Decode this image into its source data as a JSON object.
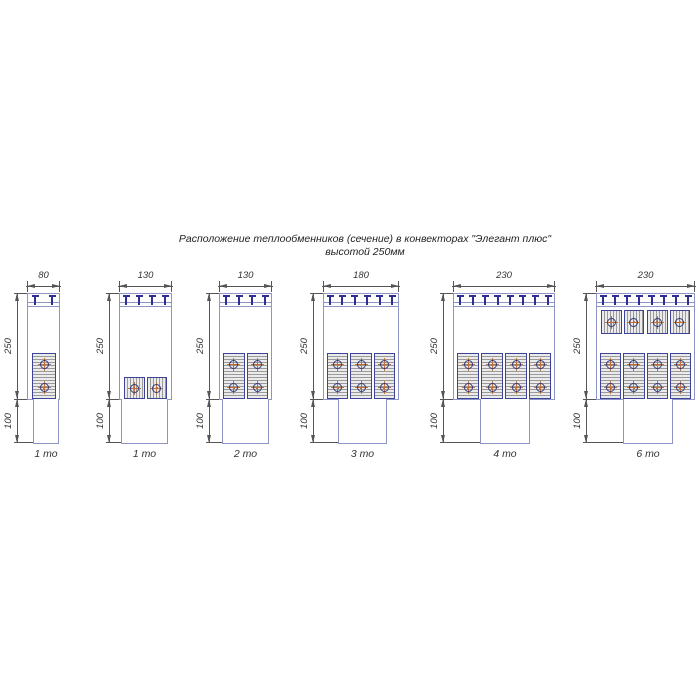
{
  "title": {
    "line1": "Расположение теплообменников (сечение) в конвекторах \"Элегант плюс\"",
    "line2": "высотой 250мм"
  },
  "dimensions": {
    "upper": "250",
    "lower": "100"
  },
  "colors": {
    "outline": "#8e96c8",
    "clip": "#2e2e96",
    "unit_border": "#3c4398",
    "hatch_fill": "#ebebeb",
    "hatch_line": "#9a9a9a",
    "tube_ring": "#333a7a",
    "tube_cross": "#c0703c",
    "dim_line": "#555555",
    "text": "#2b2b2b"
  },
  "diagrams": [
    {
      "caption": "1 то",
      "width_label": "80",
      "clip_count": 2,
      "banks": [
        {
          "position": "bottom",
          "orientation": "vertical",
          "units": 1
        }
      ]
    },
    {
      "caption": "1 то",
      "width_label": "130",
      "clip_count": 4,
      "banks": [
        {
          "position": "bottom",
          "orientation": "horizontal",
          "units": 1
        }
      ]
    },
    {
      "caption": "2 то",
      "width_label": "130",
      "clip_count": 4,
      "banks": [
        {
          "position": "bottom",
          "orientation": "vertical",
          "units": 2
        }
      ]
    },
    {
      "caption": "3 то",
      "width_label": "180",
      "clip_count": 6,
      "banks": [
        {
          "position": "bottom",
          "orientation": "vertical",
          "units": 3
        }
      ]
    },
    {
      "caption": "4 то",
      "width_label": "230",
      "clip_count": 8,
      "banks": [
        {
          "position": "bottom",
          "orientation": "vertical",
          "units": 4
        }
      ]
    },
    {
      "caption": "6 то",
      "width_label": "230",
      "clip_count": 8,
      "banks": [
        {
          "position": "top",
          "orientation": "horizontal",
          "units": 2
        },
        {
          "position": "bottom",
          "orientation": "vertical",
          "units": 4
        }
      ]
    }
  ]
}
